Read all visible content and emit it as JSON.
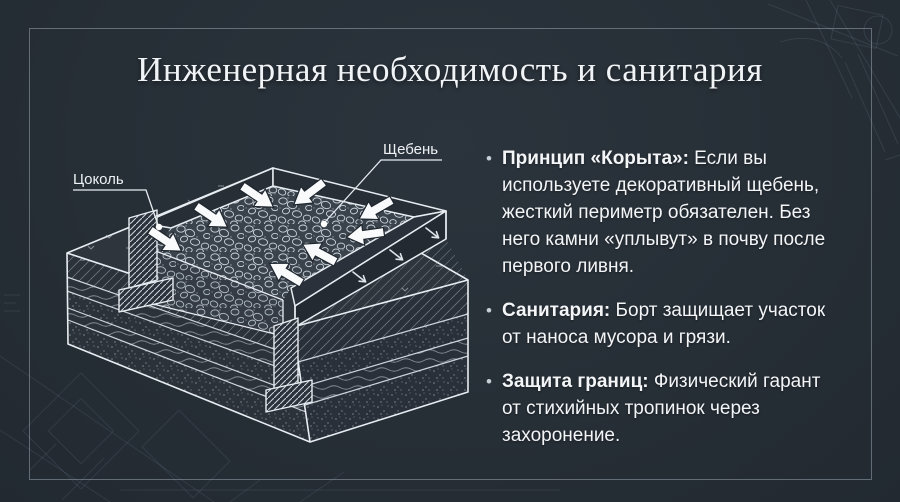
{
  "slide": {
    "title": "Инженерная необходимость и санитария",
    "bullet_char": "•",
    "bullets": [
      {
        "lead": "Принцип «Корыта»:",
        "text": " Если вы используете декоративный щебень, жесткий периметр обязателен. Без него камни «уплывут» в почву после первого ливня."
      },
      {
        "lead": "Санитария:",
        "text": " Борт защищает участок от наноса мусора и грязи."
      },
      {
        "lead": "Защита границ:",
        "text": " Физический гарант от стихийных тропинок через захоронение."
      }
    ]
  },
  "diagram": {
    "labels": {
      "plinth": "Цоколь",
      "gravel": "Щебень"
    }
  },
  "colors": {
    "background": "#262e36",
    "text": "#f3f5f7",
    "line": "#e8edf2",
    "frame_border": "#9fadb9",
    "arrow": "#f8fafc"
  }
}
